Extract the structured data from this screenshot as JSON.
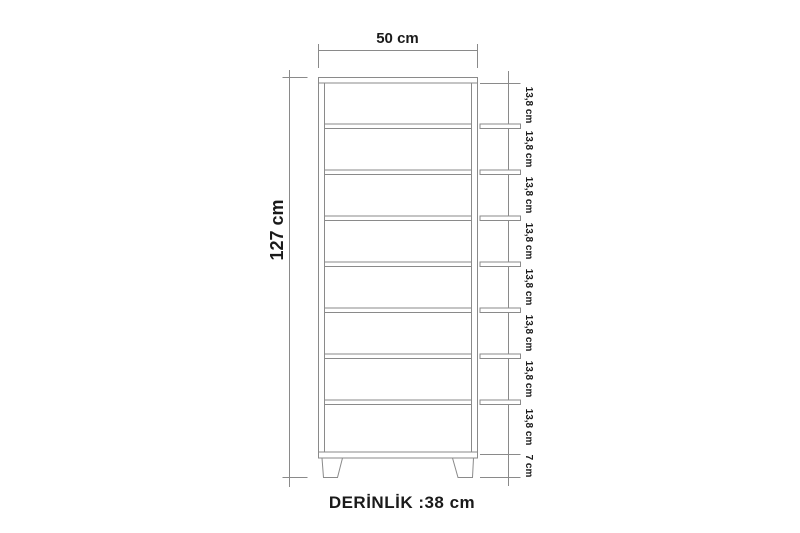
{
  "colors": {
    "line": "#8a8a8a",
    "text": "#1a1a1a",
    "background": "#ffffff"
  },
  "labels": {
    "width": "50 cm",
    "height": "127 cm",
    "shelf_spacings": [
      "13,8 cm",
      "13,8 cm",
      "13,8 cm",
      "13,8 cm",
      "13,8 cm",
      "13,8 cm",
      "13,8 cm",
      "13,8 cm"
    ],
    "leg_height": "7 cm",
    "depth": "DERİNLİK :38 cm"
  }
}
